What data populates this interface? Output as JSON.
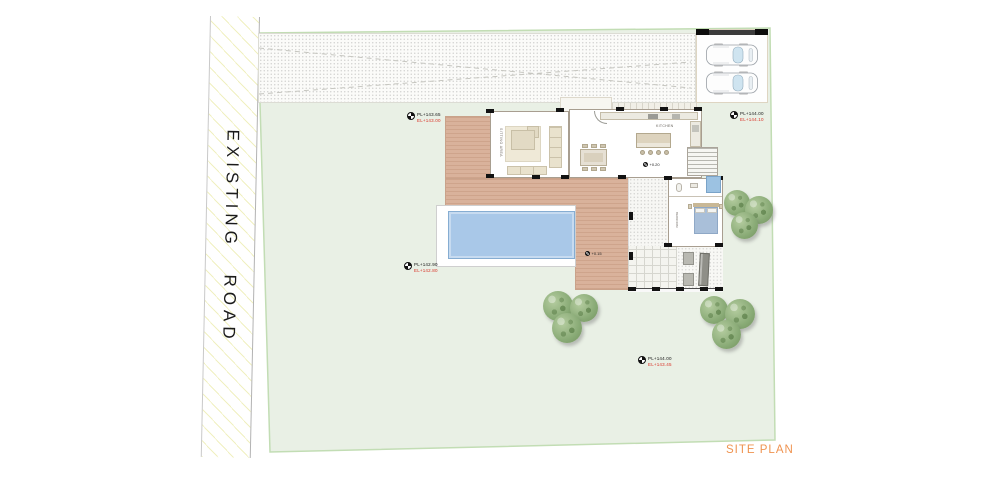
{
  "page": {
    "site_plan_label": "SITE PLAN"
  },
  "road": {
    "label": "EXISTING ROAD"
  },
  "rooms": {
    "sitting": "SITTING AREA",
    "kitchen": "KITCHEN",
    "bedroom": "BEDROOM"
  },
  "level_markers": [
    {
      "pl": "PL+143.65",
      "el": "EL+143.00"
    },
    {
      "pl": "PL+144.00",
      "el": "EL+144.10"
    },
    {
      "pl": "PL+142.90",
      "el": "EL+142.80"
    },
    {
      "pl": "PL+144.00",
      "el": "EL+143.45"
    }
  ],
  "spot_levels": [
    {
      "value": "+0.20"
    },
    {
      "value": "+0.15"
    }
  ],
  "colors": {
    "lawn": "#e9f0e5",
    "site_boundary": "#c2ddb4",
    "deck": "#d9b29b",
    "pool_water": "#a9c8e8",
    "spa_water": "#9cc2e2",
    "bed_cover": "#a9bfd9",
    "tree_green": "#86a873",
    "elevation_red": "#d93025",
    "site_plan_text": "#ef9350",
    "road_hatch_yellow": "#e4e48c",
    "wall_black": "#121212"
  }
}
